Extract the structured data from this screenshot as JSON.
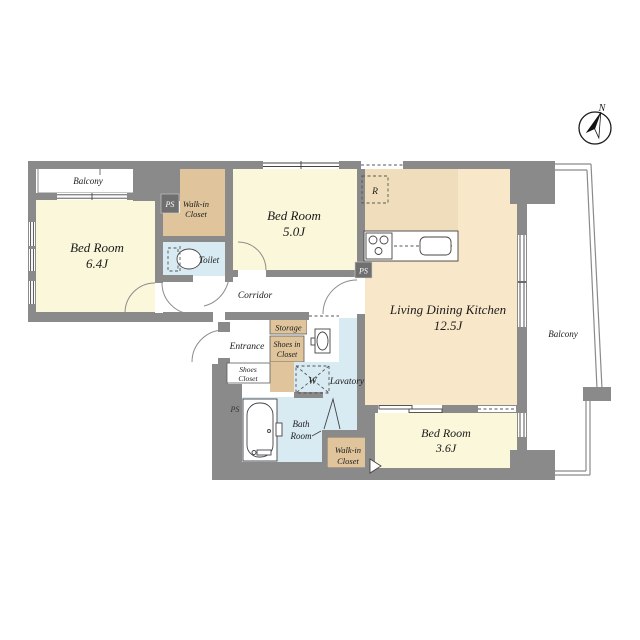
{
  "colors": {
    "wall": "#8a8a8a",
    "wall_dark": "#6f6f6f",
    "room_yellow": "#faf7da",
    "closet_tan": "#dfc49c",
    "kitchen_tan": "#efddbb",
    "ldk_peach": "#f8e7c9",
    "wet_blue": "#d8eaf2",
    "line": "#444444",
    "text": "#1b1b1b"
  },
  "rooms": {
    "balcony_top": {
      "label": "Balcony"
    },
    "balcony_right": {
      "label": "Balcony"
    },
    "bed1": {
      "name": "Bed Room",
      "area": "6.4J"
    },
    "bed2": {
      "name": "Bed Room",
      "area": "5.0J"
    },
    "bed3": {
      "name": "Bed Room",
      "area": "3.6J"
    },
    "ldk": {
      "name": "Living Dining Kitchen",
      "area": "12.5J"
    },
    "walkin_top": {
      "line1": "Walk-in",
      "line2": "Closet"
    },
    "walkin_bottom": {
      "line1": "Walk-in",
      "line2": "Closet"
    },
    "toilet": {
      "label": "Toilet"
    },
    "corridor": {
      "label": "Corridor"
    },
    "entrance": {
      "label": "Entrance"
    },
    "storage": {
      "label": "Storage"
    },
    "shoes_in_closet": {
      "line1": "Shoes in",
      "line2": "Closet"
    },
    "shoes_closet": {
      "line1": "Shoes",
      "line2": "Closet"
    },
    "lavatory": {
      "label": "Lavatory"
    },
    "bath": {
      "line1": "Bath",
      "line2": "Room"
    }
  },
  "markers": {
    "pipe_space": "PS",
    "refrigerator": "R",
    "washing_machine": "W",
    "north": "N"
  }
}
